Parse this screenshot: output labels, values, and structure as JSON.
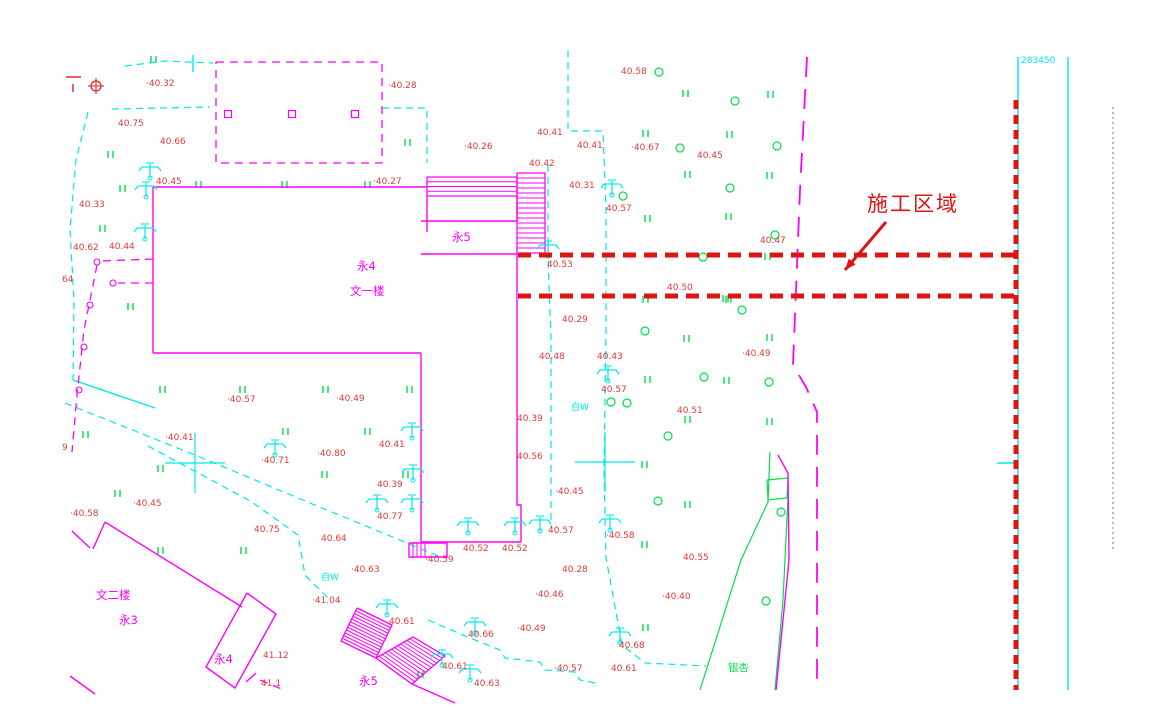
{
  "annotation": {
    "label": "施工区域"
  },
  "coordinate_label": "283450",
  "colors": {
    "magenta": "#ff00ff",
    "cyan": "#00e8e8",
    "green": "#00df4a",
    "red_label": "#e03a3a",
    "red_construction": "#dd1414",
    "gray": "#7a7a7a",
    "background": "#ffffff"
  },
  "elevation_labels": [
    {
      "t": "·40.32",
      "x": 146,
      "y": 86
    },
    {
      "t": "40.75",
      "x": 118,
      "y": 126
    },
    {
      "t": "40.66",
      "x": 160,
      "y": 144
    },
    {
      "t": "·40.28",
      "x": 388,
      "y": 88
    },
    {
      "t": "40.58",
      "x": 621,
      "y": 74
    },
    {
      "t": "·40.26",
      "x": 464,
      "y": 149
    },
    {
      "t": "40.41",
      "x": 537,
      "y": 135
    },
    {
      "t": "40.41",
      "x": 577,
      "y": 148
    },
    {
      "t": "·40.67",
      "x": 631,
      "y": 150
    },
    {
      "t": "40.45",
      "x": 697,
      "y": 158
    },
    {
      "t": "·40.27",
      "x": 373,
      "y": 184
    },
    {
      "t": "40.42",
      "x": 529,
      "y": 166
    },
    {
      "t": "40.31",
      "x": 569,
      "y": 188
    },
    {
      "t": "40.57",
      "x": 606,
      "y": 211
    },
    {
      "t": "40.45",
      "x": 156,
      "y": 184
    },
    {
      "t": "40.33",
      "x": 79,
      "y": 207
    },
    {
      "t": "40.62",
      "x": 73,
      "y": 250
    },
    {
      "t": "40.44",
      "x": 109,
      "y": 249
    },
    {
      "t": "64",
      "x": 62,
      "y": 282
    },
    {
      "t": "40.47",
      "x": 760,
      "y": 243
    },
    {
      "t": "40.53",
      "x": 547,
      "y": 267
    },
    {
      "t": "40.50",
      "x": 667,
      "y": 290
    },
    {
      "t": "40.29",
      "x": 562,
      "y": 322
    },
    {
      "t": "·40.57",
      "x": 227,
      "y": 402
    },
    {
      "t": "·40.49",
      "x": 336,
      "y": 401
    },
    {
      "t": "40.48",
      "x": 539,
      "y": 359
    },
    {
      "t": "40.43",
      "x": 597,
      "y": 359
    },
    {
      "t": "·40.49",
      "x": 742,
      "y": 356
    },
    {
      "t": "40.57",
      "x": 601,
      "y": 392
    },
    {
      "t": "40.51",
      "x": 677,
      "y": 413
    },
    {
      "t": "·40.41",
      "x": 165,
      "y": 440
    },
    {
      "t": "40.41",
      "x": 379,
      "y": 447
    },
    {
      "t": "·40.71",
      "x": 261,
      "y": 463
    },
    {
      "t": "·40.80",
      "x": 317,
      "y": 456
    },
    {
      "t": "40.39",
      "x": 377,
      "y": 487
    },
    {
      "t": "40.39",
      "x": 517,
      "y": 421
    },
    {
      "t": "40.56",
      "x": 517,
      "y": 459
    },
    {
      "t": "·40.45",
      "x": 133,
      "y": 506
    },
    {
      "t": "·40.58",
      "x": 70,
      "y": 516
    },
    {
      "t": "40.77",
      "x": 377,
      "y": 519
    },
    {
      "t": "·40.45",
      "x": 555,
      "y": 494
    },
    {
      "t": "40.75",
      "x": 254,
      "y": 532
    },
    {
      "t": "40.64",
      "x": 321,
      "y": 541
    },
    {
      "t": "40.57",
      "x": 548,
      "y": 533
    },
    {
      "t": "·40.58",
      "x": 606,
      "y": 538
    },
    {
      "t": "40.52",
      "x": 463,
      "y": 551
    },
    {
      "t": "40.52",
      "x": 502,
      "y": 551
    },
    {
      "t": "·40.59",
      "x": 425,
      "y": 562
    },
    {
      "t": "·40.63",
      "x": 351,
      "y": 572
    },
    {
      "t": "40.28",
      "x": 562,
      "y": 572
    },
    {
      "t": "·40.46",
      "x": 535,
      "y": 597
    },
    {
      "t": "·41.04",
      "x": 312,
      "y": 603
    },
    {
      "t": "40.55",
      "x": 683,
      "y": 560
    },
    {
      "t": "40.61",
      "x": 389,
      "y": 624
    },
    {
      "t": "40.66",
      "x": 468,
      "y": 637
    },
    {
      "t": "·40.49",
      "x": 517,
      "y": 631
    },
    {
      "t": "·40.40",
      "x": 662,
      "y": 599
    },
    {
      "t": "40.61",
      "x": 442,
      "y": 669
    },
    {
      "t": "·40.57",
      "x": 554,
      "y": 671
    },
    {
      "t": "40.68",
      "x": 619,
      "y": 648
    },
    {
      "t": "40.61",
      "x": 611,
      "y": 671
    },
    {
      "t": "41.12",
      "x": 263,
      "y": 658
    },
    {
      "t": "40.63",
      "x": 474,
      "y": 686
    },
    {
      "t": "9",
      "x": 62,
      "y": 450
    },
    {
      "t": "41.1",
      "x": 261,
      "y": 686
    }
  ],
  "building_labels": [
    {
      "t": "永4",
      "x": 357,
      "y": 270
    },
    {
      "t": "文一楼",
      "x": 350,
      "y": 295
    },
    {
      "t": "永5",
      "x": 452,
      "y": 241
    },
    {
      "t": "文二楼",
      "x": 96,
      "y": 599
    },
    {
      "t": "永3",
      "x": 119,
      "y": 624
    },
    {
      "t": "永4",
      "x": 214,
      "y": 663
    },
    {
      "t": "永5",
      "x": 359,
      "y": 685
    }
  ],
  "well_labels": [
    {
      "t": "自W",
      "x": 571,
      "y": 410
    },
    {
      "t": "自W",
      "x": 321,
      "y": 580
    }
  ],
  "area_labels": [
    {
      "t": "银杏",
      "x": 728,
      "y": 671
    }
  ],
  "construction": {
    "h_lines": [
      [
        [
          518,
          255
        ],
        [
          1016,
          255
        ]
      ],
      [
        [
          518,
          296
        ],
        [
          1016,
          296
        ]
      ]
    ],
    "v_line": [
      [
        1016,
        100
      ],
      [
        1016,
        690
      ]
    ],
    "arrow": [
      [
        886,
        222
      ],
      [
        845,
        270
      ]
    ],
    "label_x": 867,
    "label_y": 211
  },
  "lines": {
    "magenta_solid": [
      [
        [
          153,
          187
        ],
        [
          427,
          187
        ]
      ],
      [
        [
          153,
          187
        ],
        [
          153,
          353
        ]
      ],
      [
        [
          153,
          353
        ],
        [
          421,
          353
        ]
      ],
      [
        [
          421,
          353
        ],
        [
          421,
          542
        ]
      ],
      [
        [
          421,
          542
        ],
        [
          521,
          542
        ]
      ],
      [
        [
          521,
          542
        ],
        [
          521,
          505
        ],
        [
          517,
          505
        ],
        [
          517,
          253
        ]
      ],
      [
        [
          427,
          196
        ],
        [
          427,
          232
        ]
      ],
      [
        [
          517,
          196
        ],
        [
          517,
          221
        ]
      ],
      [
        [
          421,
          221
        ],
        [
          517,
          221
        ]
      ],
      [
        [
          421,
          254
        ],
        [
          517,
          254
        ]
      ],
      [
        [
          409,
          543
        ],
        [
          447,
          543
        ],
        [
          447,
          557
        ],
        [
          409,
          557
        ],
        [
          409,
          543
        ]
      ],
      [
        [
          72,
          531
        ],
        [
          90,
          548
        ]
      ],
      [
        [
          105,
          522
        ],
        [
          93,
          549
        ]
      ],
      [
        [
          105,
          522
        ],
        [
          242,
          607
        ]
      ],
      [
        [
          247,
          593
        ],
        [
          276,
          614
        ],
        [
          235,
          688
        ],
        [
          206,
          667
        ],
        [
          247,
          593
        ]
      ],
      [
        [
          70,
          676
        ],
        [
          95,
          694
        ]
      ],
      [
        [
          412,
          684
        ],
        [
          455,
          703
        ]
      ],
      [
        [
          256,
          673
        ],
        [
          246,
          682
        ]
      ],
      [
        [
          778,
          455
        ],
        [
          788,
          473
        ],
        [
          789,
          560
        ],
        [
          776,
          690
        ]
      ]
    ],
    "magenta_dashed": [
      [
        [
          216,
          62
        ],
        [
          382,
          62
        ],
        [
          382,
          163
        ],
        [
          216,
          163
        ],
        [
          216,
          62
        ]
      ],
      [
        [
          153,
          259
        ],
        [
          101,
          261
        ]
      ],
      [
        [
          153,
          283
        ],
        [
          118,
          283
        ]
      ],
      [
        [
          97,
          265
        ],
        [
          84,
          330
        ],
        [
          77,
          395
        ],
        [
          72,
          452
        ]
      ],
      [
        [
          260,
          680
        ],
        [
          284,
          690
        ]
      ]
    ],
    "road_dashed": [
      [
        [
          807,
          57
        ],
        [
          800,
          190
        ],
        [
          796,
          290
        ],
        [
          793,
          365
        ],
        [
          806,
          387
        ],
        [
          817,
          412
        ],
        [
          817,
          690
        ]
      ]
    ],
    "cyan_dashed": [
      [
        [
          125,
          66
        ],
        [
          165,
          61
        ],
        [
          213,
          63
        ]
      ],
      [
        [
          112,
          109
        ],
        [
          210,
          107
        ]
      ],
      [
        [
          88,
          112
        ],
        [
          76,
          160
        ],
        [
          70,
          230
        ],
        [
          74,
          300
        ],
        [
          73,
          380
        ]
      ],
      [
        [
          382,
          108
        ],
        [
          427,
          108
        ],
        [
          427,
          163
        ]
      ],
      [
        [
          568,
          50
        ],
        [
          568,
          131
        ],
        [
          603,
          131
        ],
        [
          606,
          210
        ],
        [
          606,
          330
        ],
        [
          604,
          470
        ],
        [
          606,
          558
        ],
        [
          612,
          590
        ],
        [
          622,
          645
        ],
        [
          645,
          663
        ],
        [
          706,
          666
        ]
      ],
      [
        [
          548,
          165
        ],
        [
          548,
          255
        ],
        [
          551,
          340
        ],
        [
          551,
          528
        ]
      ],
      [
        [
          65,
          403
        ],
        [
          200,
          457
        ],
        [
          310,
          503
        ],
        [
          395,
          538
        ],
        [
          438,
          556
        ]
      ],
      [
        [
          148,
          446
        ],
        [
          252,
          502
        ],
        [
          298,
          535
        ],
        [
          305,
          575
        ],
        [
          330,
          600
        ]
      ],
      [
        [
          428,
          620
        ],
        [
          470,
          638
        ],
        [
          500,
          650
        ],
        [
          505,
          658
        ],
        [
          540,
          662
        ],
        [
          545,
          670
        ],
        [
          575,
          672
        ],
        [
          580,
          680
        ],
        [
          600,
          684
        ]
      ]
    ],
    "cyan_solid": [
      [
        [
          1018,
          57
        ],
        [
          1018,
          690
        ]
      ],
      [
        [
          1068,
          57
        ],
        [
          1068,
          690
        ]
      ],
      [
        [
          997,
          463
        ],
        [
          1018,
          463
        ]
      ],
      [
        [
          193,
          55
        ],
        [
          193,
          72
        ]
      ],
      [
        [
          73,
          380
        ],
        [
          155,
          408
        ]
      ]
    ],
    "green_solid": [
      [
        [
          770,
          452
        ],
        [
          768,
          502
        ],
        [
          741,
          560
        ],
        [
          700,
          690
        ]
      ],
      [
        [
          767,
          480
        ],
        [
          788,
          478
        ],
        [
          787,
          498
        ],
        [
          768,
          500
        ],
        [
          767,
          480
        ]
      ],
      [
        [
          788,
          498
        ],
        [
          783,
          600
        ],
        [
          775,
          690
        ]
      ]
    ],
    "gray_dotted": [
      [
        [
          1113,
          107
        ],
        [
          1113,
          550
        ]
      ]
    ],
    "red_marks": [
      [
        [
          66,
          77
        ],
        [
          81,
          77
        ]
      ],
      [
        [
          73,
          84
        ],
        [
          73,
          92
        ]
      ]
    ]
  },
  "hatch_quads": [
    {
      "q": [
        [
          517,
          173
        ],
        [
          545,
          173
        ],
        [
          545,
          253
        ],
        [
          517,
          253
        ]
      ],
      "n": 16,
      "outline": true
    },
    {
      "q": [
        [
          427,
          177
        ],
        [
          517,
          177
        ],
        [
          517,
          196
        ],
        [
          427,
          196
        ]
      ],
      "n": 4,
      "outline": true
    },
    {
      "q": [
        [
          357,
          608
        ],
        [
          392,
          625
        ],
        [
          376,
          658
        ],
        [
          341,
          641
        ]
      ],
      "n": 12,
      "outline": true
    },
    {
      "q": [
        [
          413,
          637
        ],
        [
          445,
          656
        ],
        [
          412,
          684
        ],
        [
          376,
          658
        ]
      ],
      "n": 12,
      "outline": true
    },
    {
      "q": [
        [
          409,
          543
        ],
        [
          409,
          557
        ],
        [
          425,
          557
        ],
        [
          425,
          543
        ]
      ],
      "n": 4,
      "outline": false
    }
  ],
  "symbols": {
    "benchmark": {
      "x": 96,
      "y": 86
    },
    "grid_crosses": [
      [
        195,
        463
      ],
      [
        605,
        462
      ]
    ],
    "squares": [
      [
        228,
        114
      ],
      [
        292,
        114
      ],
      [
        355,
        114
      ]
    ],
    "poles": [
      [
        97,
        262
      ],
      [
        113,
        283
      ],
      [
        90,
        305
      ],
      [
        84,
        347
      ],
      [
        79,
        390
      ]
    ],
    "trees": [
      [
        150,
        175
      ],
      [
        146,
        194
      ],
      [
        145,
        236
      ],
      [
        612,
        192
      ],
      [
        548,
        253
      ],
      [
        275,
        452
      ],
      [
        412,
        435
      ],
      [
        413,
        477
      ],
      [
        377,
        507
      ],
      [
        412,
        507
      ],
      [
        468,
        530
      ],
      [
        515,
        530
      ],
      [
        540,
        528
      ],
      [
        610,
        527
      ],
      [
        608,
        378
      ],
      [
        620,
        640
      ],
      [
        475,
        630
      ],
      [
        442,
        662
      ],
      [
        470,
        677
      ],
      [
        387,
        612
      ]
    ],
    "shrubs": [
      [
        659,
        72
      ],
      [
        735,
        101
      ],
      [
        680,
        148
      ],
      [
        777,
        146
      ],
      [
        730,
        188
      ],
      [
        623,
        196
      ],
      [
        775,
        235
      ],
      [
        703,
        257
      ],
      [
        742,
        310
      ],
      [
        645,
        331
      ],
      [
        704,
        377
      ],
      [
        769,
        382
      ],
      [
        627,
        403
      ],
      [
        668,
        436
      ],
      [
        611,
        402
      ],
      [
        658,
        501
      ],
      [
        781,
        512
      ],
      [
        766,
        601
      ]
    ],
    "grass": [
      [
        151,
        63
      ],
      [
        108,
        158
      ],
      [
        120,
        192
      ],
      [
        196,
        188
      ],
      [
        282,
        188
      ],
      [
        365,
        188
      ],
      [
        405,
        146
      ],
      [
        643,
        137
      ],
      [
        645,
        222
      ],
      [
        683,
        97
      ],
      [
        768,
        98
      ],
      [
        727,
        138
      ],
      [
        685,
        178
      ],
      [
        767,
        179
      ],
      [
        726,
        220
      ],
      [
        765,
        260
      ],
      [
        723,
        302
      ],
      [
        643,
        303
      ],
      [
        726,
        303
      ],
      [
        684,
        342
      ],
      [
        767,
        341
      ],
      [
        645,
        383
      ],
      [
        724,
        384
      ],
      [
        685,
        423
      ],
      [
        767,
        425
      ],
      [
        100,
        232
      ],
      [
        128,
        310
      ],
      [
        160,
        393
      ],
      [
        240,
        393
      ],
      [
        323,
        393
      ],
      [
        83,
        438
      ],
      [
        158,
        472
      ],
      [
        115,
        497
      ],
      [
        283,
        435
      ],
      [
        365,
        435
      ],
      [
        322,
        478
      ],
      [
        158,
        554
      ],
      [
        241,
        554
      ],
      [
        407,
        393
      ],
      [
        403,
        478
      ],
      [
        642,
        468
      ],
      [
        642,
        548
      ],
      [
        643,
        631
      ],
      [
        418,
        678
      ],
      [
        685,
        508
      ]
    ]
  }
}
